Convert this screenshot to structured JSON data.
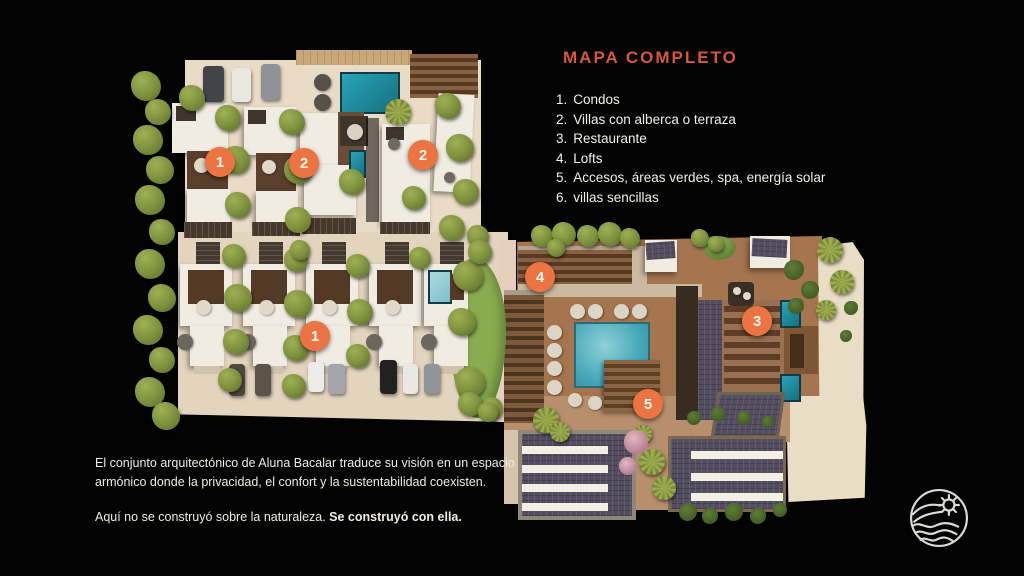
{
  "slide": {
    "title": "MAPA COMPLETO"
  },
  "colors": {
    "accent_orange": "#D65A36",
    "marker_orange": "#EB7442",
    "background": "#000000",
    "deck_brown": "#A4754F",
    "ground_beige": "#E5D6C0",
    "pool_teal": "#3FA3B8"
  },
  "legend": {
    "items": [
      {
        "number": "1.",
        "label": "Condos"
      },
      {
        "number": "2.",
        "label": "Villas con alberca o terraza"
      },
      {
        "number": "3.",
        "label": "Restaurante"
      },
      {
        "number": "4.",
        "label": "Lofts"
      },
      {
        "number": "5.",
        "label": "Accesos, áreas verdes, spa, energía solar"
      },
      {
        "number": "6.",
        "label": "villas sencillas"
      }
    ]
  },
  "map": {
    "markers": [
      {
        "label": "1"
      },
      {
        "label": "2"
      },
      {
        "label": "2"
      },
      {
        "label": "1"
      },
      {
        "label": "4"
      },
      {
        "label": "3"
      },
      {
        "label": "5"
      }
    ]
  },
  "description": {
    "paragraph1_line1": "El conjunto arquitectónico de Aluna Bacalar traduce su visión en un espacio",
    "paragraph1_line2": "armónico donde la privacidad, el confort y la sustentabilidad coexisten.",
    "paragraph2_text": "Aquí no se construyó sobre la naturaleza. ",
    "paragraph2_bold": "Se construyó con ella."
  },
  "icons": {
    "logo": "wave-sun-circle-logo"
  }
}
